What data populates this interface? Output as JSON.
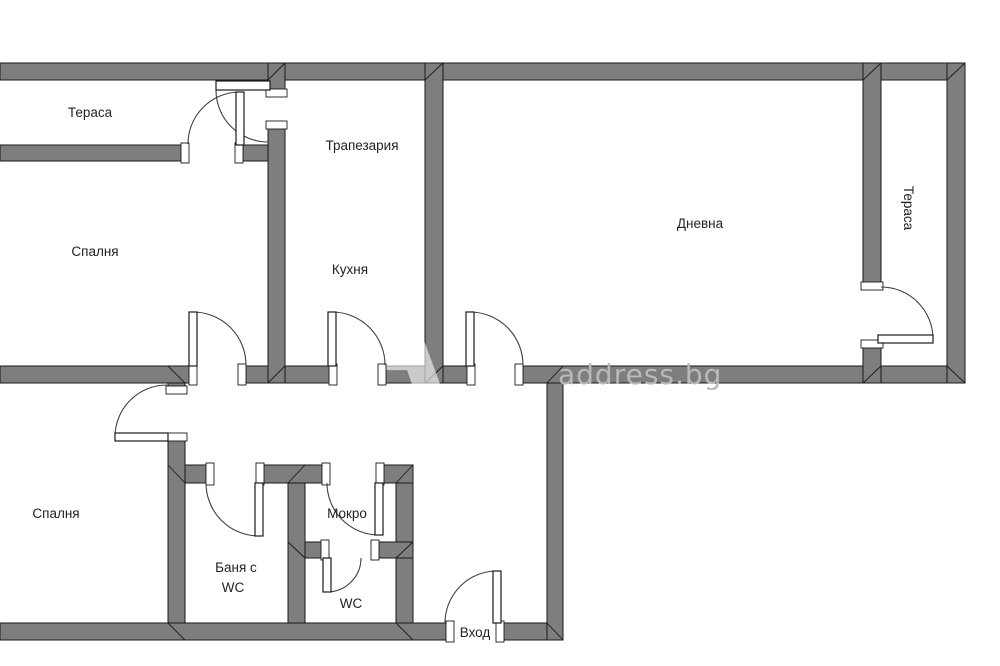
{
  "title": "Apartment floor plan",
  "watermark": {
    "letter": "A",
    "brand": "address.bg"
  },
  "rooms": {
    "terrace_left": "Тераса",
    "bedroom_top": "Спалня",
    "dining": "Трапезария",
    "kitchen": "Кухня",
    "living": "Дневна",
    "terrace_right": "Тераса",
    "bedroom_bottom": "Спалня",
    "bathroom_line1": "Баня с",
    "bathroom_line2": "WC",
    "wet_room": "Мокро",
    "wc": "WC",
    "entrance": "Вход"
  },
  "colors": {
    "wall": "#7e7e7e",
    "background": "#ffffff",
    "outline": "#1a1a1a",
    "label": "#222222",
    "watermark": "#b9b9b9"
  }
}
